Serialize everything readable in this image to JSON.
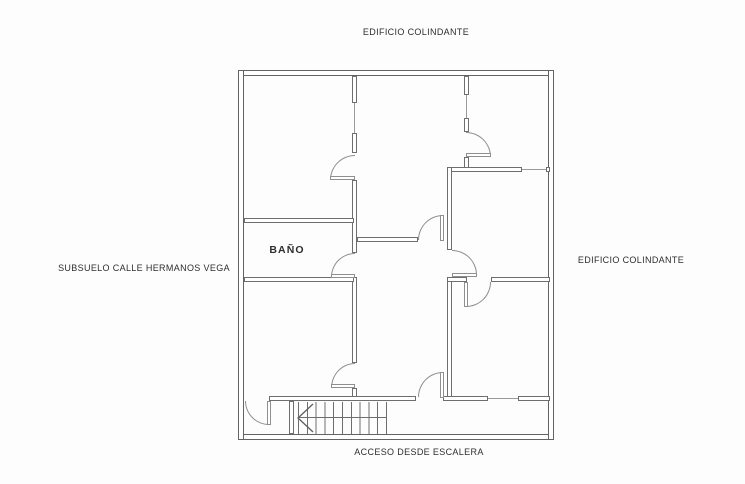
{
  "labels": {
    "top_neighbor": "EDIFICIO COLINDANTE",
    "right_neighbor": "EDIFICIO COLINDANTE",
    "left_street": "SUBSUELO CALLE HERMANOS VEGA",
    "bottom_access": "ACCESO DESDE ESCALERA",
    "bathroom": "BAÑO"
  },
  "colors": {
    "background": "#fdfdfd",
    "wall_outline": "#6e6e6e",
    "outer_wall_outline": "#636363",
    "door_arc": "#8f8f8f",
    "window_line": "#9a9a9a",
    "text": "#2e2e2e"
  }
}
